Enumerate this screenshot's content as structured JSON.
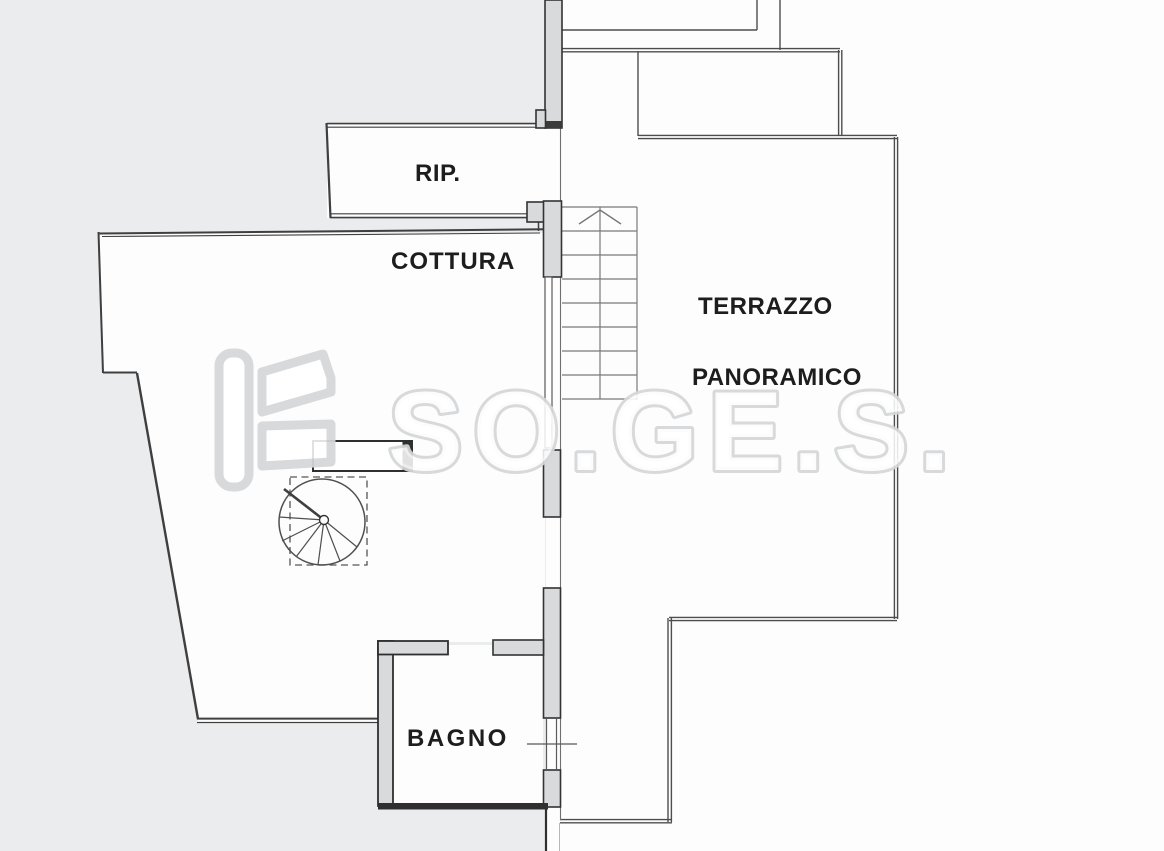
{
  "document": {
    "kind": "architectural floor plan (scanned)",
    "floor_items": "straight staircase with up arrow, spiral staircase, kitchen counter block, window symbol"
  },
  "rooms": {
    "rip": {
      "label": "RIP."
    },
    "cottura": {
      "label": "COTTURA"
    },
    "terrazzo": {
      "label_line1": "TERRAZZO",
      "label_line2": "PANORAMICO"
    },
    "bagno": {
      "label": "BAGNO"
    }
  },
  "watermark": {
    "text": "SO.GE.S."
  },
  "colors": {
    "background": "#ebecee",
    "paper": "#fdfdfd",
    "wall_fill": "#d9dadc",
    "wall_dark": "#2f2f2f",
    "line": "#4d4d4d",
    "stair_line": "#7a7a7a",
    "label_text": "#1d1d1d",
    "watermark_outline": "#d5d7d9"
  }
}
